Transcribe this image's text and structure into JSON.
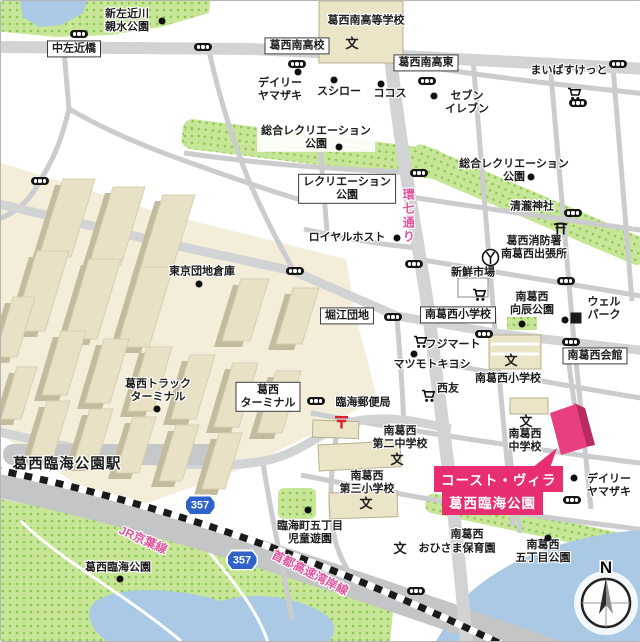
{
  "map": {
    "target": {
      "line1": "コースト・ヴィラ",
      "line2": "葛西臨海公園",
      "accent_color": "#e62e70"
    },
    "compass": {
      "north": "N"
    },
    "route_shields": [
      {
        "t": "357",
        "x": 199,
        "y": 504
      },
      {
        "t": "357",
        "x": 241,
        "y": 559
      }
    ],
    "colors": {
      "road": "#cdced0",
      "park_green": "#c8e698",
      "water": "#aac9e4",
      "warehouse": "#e9e1c6",
      "highlight_pink": "#e62e70",
      "road_label_pink": "#e0559e",
      "route_shield_blue": "#2f63c9"
    },
    "labels": [
      {
        "n": "shin-sakongawa-park-label",
        "t": "新左近川\n親水公園",
        "x": 126,
        "y": 20,
        "c": "place"
      },
      {
        "n": "naka-sakonbashi-label",
        "t": "中左近橋",
        "x": 73,
        "y": 48,
        "c": "boxed"
      },
      {
        "n": "kasai-minami-highschool-label",
        "t": "葛西南高等学校",
        "x": 365,
        "y": 20,
        "c": "place"
      },
      {
        "n": "kasai-minami-koko-intersection-label",
        "t": "葛西南高校",
        "x": 296,
        "y": 45,
        "c": "boxed"
      },
      {
        "n": "kasai-minami-higashi-intersection-label",
        "t": "葛西南高東",
        "x": 425,
        "y": 62,
        "c": "boxed"
      },
      {
        "n": "mybasket-label",
        "t": "まいばすけっと",
        "x": 568,
        "y": 70,
        "c": "place"
      },
      {
        "n": "daily-yamazaki-north-label",
        "t": "デイリー\nヤマザキ",
        "x": 279,
        "y": 89,
        "c": "place"
      },
      {
        "n": "sushiro-label",
        "t": "スシロー",
        "x": 338,
        "y": 91,
        "c": "place"
      },
      {
        "n": "cocos-label",
        "t": "ココス",
        "x": 389,
        "y": 93,
        "c": "place"
      },
      {
        "n": "seven-eleven-label",
        "t": "セブン\nイレブン",
        "x": 466,
        "y": 102,
        "c": "place"
      },
      {
        "n": "sogo-recreation-park-west-label",
        "t": "総合レクリエーション\n公園",
        "x": 315,
        "y": 137,
        "c": "halo-box"
      },
      {
        "n": "sogo-recreation-park-east-label",
        "t": "総合レクリエーション\n公園",
        "x": 513,
        "y": 170,
        "c": "place"
      },
      {
        "n": "recreation-park-label",
        "t": "レクリエーション\n公園",
        "x": 346,
        "y": 188,
        "c": "boxed"
      },
      {
        "n": "kannana-dori-road-label",
        "t": "環七通り",
        "x": 407,
        "y": 215,
        "c": "pink-road vert"
      },
      {
        "n": "royal-host-label",
        "t": "ロイヤルホスト",
        "x": 346,
        "y": 237,
        "c": "place"
      },
      {
        "n": "seiryu-jinja-label",
        "t": "清瀧神社",
        "x": 531,
        "y": 206,
        "c": "place"
      },
      {
        "n": "kasai-fire-station-label",
        "t": "葛西消防署\n南葛西出張所",
        "x": 533,
        "y": 247,
        "c": "place"
      },
      {
        "n": "tokyo-danchi-soko-label",
        "t": "東京団地倉庫",
        "x": 201,
        "y": 271,
        "c": "place"
      },
      {
        "n": "shinsen-ichiba-label",
        "t": "新鮮市場",
        "x": 472,
        "y": 272,
        "c": "place"
      },
      {
        "n": "horie-danchi-label",
        "t": "堀江団地",
        "x": 346,
        "y": 315,
        "c": "boxed"
      },
      {
        "n": "minami-kasai-sho-intersection-label",
        "t": "南葛西小学校",
        "x": 457,
        "y": 314,
        "c": "boxed"
      },
      {
        "n": "mukaitatsu-park-label",
        "t": "南葛西\n向辰公園",
        "x": 531,
        "y": 303,
        "c": "place"
      },
      {
        "n": "well-park-label",
        "t": "ウェル\nパーク",
        "x": 603,
        "y": 308,
        "c": "place"
      },
      {
        "n": "minami-kasai-kaikan-label",
        "t": "南葛西会館",
        "x": 594,
        "y": 355,
        "c": "boxed"
      },
      {
        "n": "fuji-mart-label",
        "t": "フジマート",
        "x": 452,
        "y": 344,
        "c": "place"
      },
      {
        "n": "matsumoto-kiyoshi-label",
        "t": "マツモトキヨシ",
        "x": 431,
        "y": 364,
        "c": "place"
      },
      {
        "n": "minami-kasai-elementary-label",
        "t": "南葛西小学校",
        "x": 507,
        "y": 378,
        "c": "place"
      },
      {
        "n": "seiyu-label",
        "t": "西友",
        "x": 447,
        "y": 388,
        "c": "place"
      },
      {
        "n": "kasai-terminal-label",
        "t": "葛西\nターミナル",
        "x": 267,
        "y": 396,
        "c": "boxed"
      },
      {
        "n": "kasai-truck-terminal-label",
        "t": "葛西トラック\nターミナル",
        "x": 157,
        "y": 390,
        "c": "place"
      },
      {
        "n": "rinkai-post-office-label",
        "t": "臨海郵便局",
        "x": 362,
        "y": 402,
        "c": "place"
      },
      {
        "n": "dai2-junior-high-label",
        "t": "南葛西\n第二中学校",
        "x": 399,
        "y": 437,
        "c": "place"
      },
      {
        "n": "minami-kasai-junior-high-label",
        "t": "南葛西\n中学校",
        "x": 524,
        "y": 440,
        "c": "place"
      },
      {
        "n": "dai3-elementary-label",
        "t": "南葛西\n第三小学校",
        "x": 366,
        "y": 482,
        "c": "place"
      },
      {
        "n": "rinkai-cho-jido-yuen-label",
        "t": "臨海町五丁目\n児童遊園",
        "x": 309,
        "y": 532,
        "c": "place"
      },
      {
        "n": "ohisama-nursery-line1-label",
        "t": "南葛西",
        "x": 466,
        "y": 534,
        "c": "place"
      },
      {
        "n": "ohisama-nursery-line2-label",
        "t": "おひさま保育園",
        "x": 456,
        "y": 548,
        "c": "place"
      },
      {
        "n": "daily-yamazaki-south-label",
        "t": "デイリー\nヤマザキ",
        "x": 608,
        "y": 485,
        "c": "place"
      },
      {
        "n": "gochome-park-label",
        "t": "南葛西\n五丁目公園",
        "x": 542,
        "y": 551,
        "c": "place"
      },
      {
        "n": "kasai-rinkai-park-label",
        "t": "葛西臨海公園",
        "x": 117,
        "y": 567,
        "c": "place"
      },
      {
        "n": "kasai-rinkai-park-station-label",
        "t": "葛西臨海公園駅",
        "x": 66,
        "y": 464,
        "c": "station"
      },
      {
        "n": "jr-keiyo-line-label",
        "t": "JR京葉線",
        "x": 142,
        "y": 539,
        "c": "pink-road",
        "r": 24
      },
      {
        "n": "shuto-expressway-wangan-label",
        "t": "首都高速湾岸線",
        "x": 309,
        "y": 572,
        "c": "pink-road",
        "r": 27
      },
      {
        "n": "school-mark-kasai-minami",
        "t": "文",
        "x": 351,
        "y": 43,
        "c": "bun"
      },
      {
        "n": "school-mark-minami-kasai-sho",
        "t": "文",
        "x": 510,
        "y": 360,
        "c": "bun"
      },
      {
        "n": "school-mark-dai2-chu",
        "t": "文",
        "x": 396,
        "y": 459,
        "c": "bun"
      },
      {
        "n": "school-mark-dai3-sho",
        "t": "文",
        "x": 365,
        "y": 503,
        "c": "bun"
      },
      {
        "n": "school-mark-minami-kasai-chu",
        "t": "文",
        "x": 525,
        "y": 421,
        "c": "bun"
      },
      {
        "n": "school-mark-ohisama",
        "t": "文",
        "x": 399,
        "y": 548,
        "c": "bun"
      }
    ],
    "icons": [
      {
        "k": "signal",
        "x": 78,
        "y": 33
      },
      {
        "k": "signal",
        "x": 202,
        "y": 46
      },
      {
        "k": "signal",
        "x": 296,
        "y": 63
      },
      {
        "k": "signal",
        "x": 617,
        "y": 63
      },
      {
        "k": "signal",
        "x": 577,
        "y": 102
      },
      {
        "k": "signal",
        "x": 426,
        "y": 80
      },
      {
        "k": "signal",
        "x": 418,
        "y": 172
      },
      {
        "k": "signal",
        "x": 39,
        "y": 180
      },
      {
        "k": "signal",
        "x": 294,
        "y": 270
      },
      {
        "k": "signal",
        "x": 413,
        "y": 263
      },
      {
        "k": "signal",
        "x": 572,
        "y": 212
      },
      {
        "k": "signal",
        "x": 565,
        "y": 280
      },
      {
        "k": "signal",
        "x": 570,
        "y": 341
      },
      {
        "k": "signal",
        "x": 392,
        "y": 316
      },
      {
        "k": "signal",
        "x": 483,
        "y": 333
      },
      {
        "k": "signal",
        "x": 315,
        "y": 400
      },
      {
        "k": "signal",
        "x": 571,
        "y": 499
      },
      {
        "k": "signal",
        "x": 415,
        "y": 590
      },
      {
        "k": "dot",
        "x": 161,
        "y": 20
      },
      {
        "k": "dot",
        "x": 297,
        "y": 71
      },
      {
        "k": "dot",
        "x": 333,
        "y": 79
      },
      {
        "k": "dot",
        "x": 380,
        "y": 83
      },
      {
        "k": "dot",
        "x": 433,
        "y": 95
      },
      {
        "k": "dot",
        "x": 338,
        "y": 146
      },
      {
        "k": "dot",
        "x": 530,
        "y": 176
      },
      {
        "k": "dot",
        "x": 396,
        "y": 237
      },
      {
        "k": "dot",
        "x": 198,
        "y": 283
      },
      {
        "k": "dot",
        "x": 413,
        "y": 353
      },
      {
        "k": "dot",
        "x": 156,
        "y": 408
      },
      {
        "k": "dot",
        "x": 521,
        "y": 323
      },
      {
        "k": "dot",
        "x": 564,
        "y": 319
      },
      {
        "k": "dot",
        "x": 307,
        "y": 509
      },
      {
        "k": "dot",
        "x": 547,
        "y": 537
      },
      {
        "k": "dot",
        "x": 119,
        "y": 578
      },
      {
        "k": "dot",
        "x": 573,
        "y": 477
      },
      {
        "k": "cart",
        "x": 566,
        "y": 86
      },
      {
        "k": "cart",
        "x": 471,
        "y": 287
      },
      {
        "k": "cart",
        "x": 412,
        "y": 334
      },
      {
        "k": "cart",
        "x": 420,
        "y": 388
      },
      {
        "k": "torii",
        "x": 552,
        "y": 221
      },
      {
        "k": "fire",
        "x": 480,
        "y": 247
      },
      {
        "k": "post",
        "x": 333,
        "y": 414
      },
      {
        "k": "square",
        "x": 575,
        "y": 317
      }
    ]
  }
}
